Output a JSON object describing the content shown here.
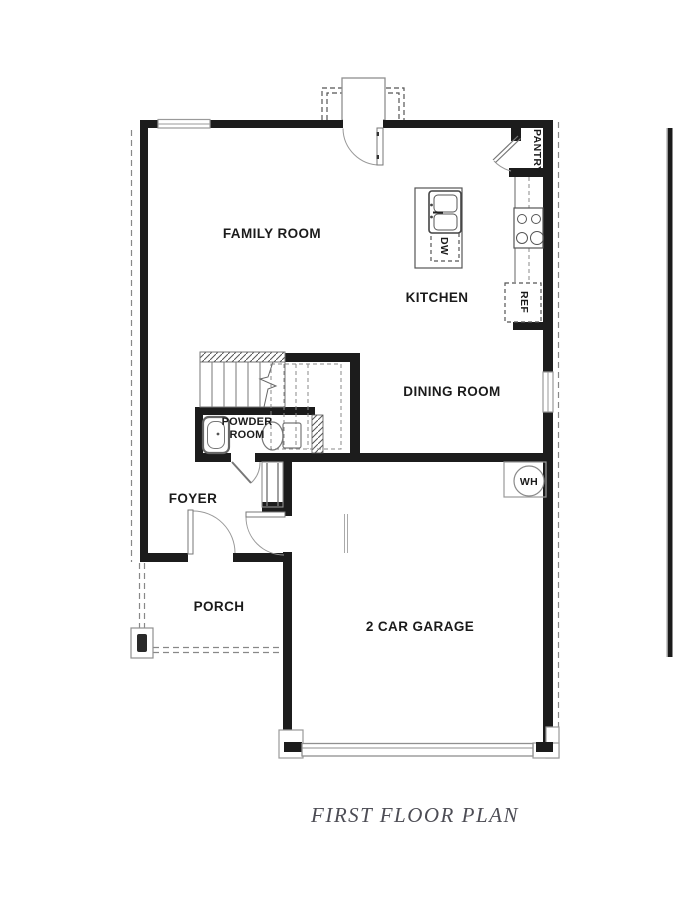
{
  "plan": {
    "title": "FIRST FLOOR PLAN"
  },
  "rooms": {
    "family_room": "FAMILY ROOM",
    "kitchen": "KITCHEN",
    "dining_room": "DINING ROOM",
    "powder_line1": "POWDER",
    "powder_line2": "ROOM",
    "foyer": "FOYER",
    "porch": "PORCH",
    "garage": "2 CAR GARAGE",
    "pantry": "PANTRY"
  },
  "fixtures": {
    "dishwasher": "DW",
    "refrigerator": "REF",
    "water_heater": "WH"
  },
  "colors": {
    "wall": "#1c1c1c",
    "fixture_line": "#8f8f8f",
    "dashed_line": "#888888",
    "label_text": "#1b1b1b",
    "title_text": "#4d4d55",
    "background": "#ffffff"
  }
}
